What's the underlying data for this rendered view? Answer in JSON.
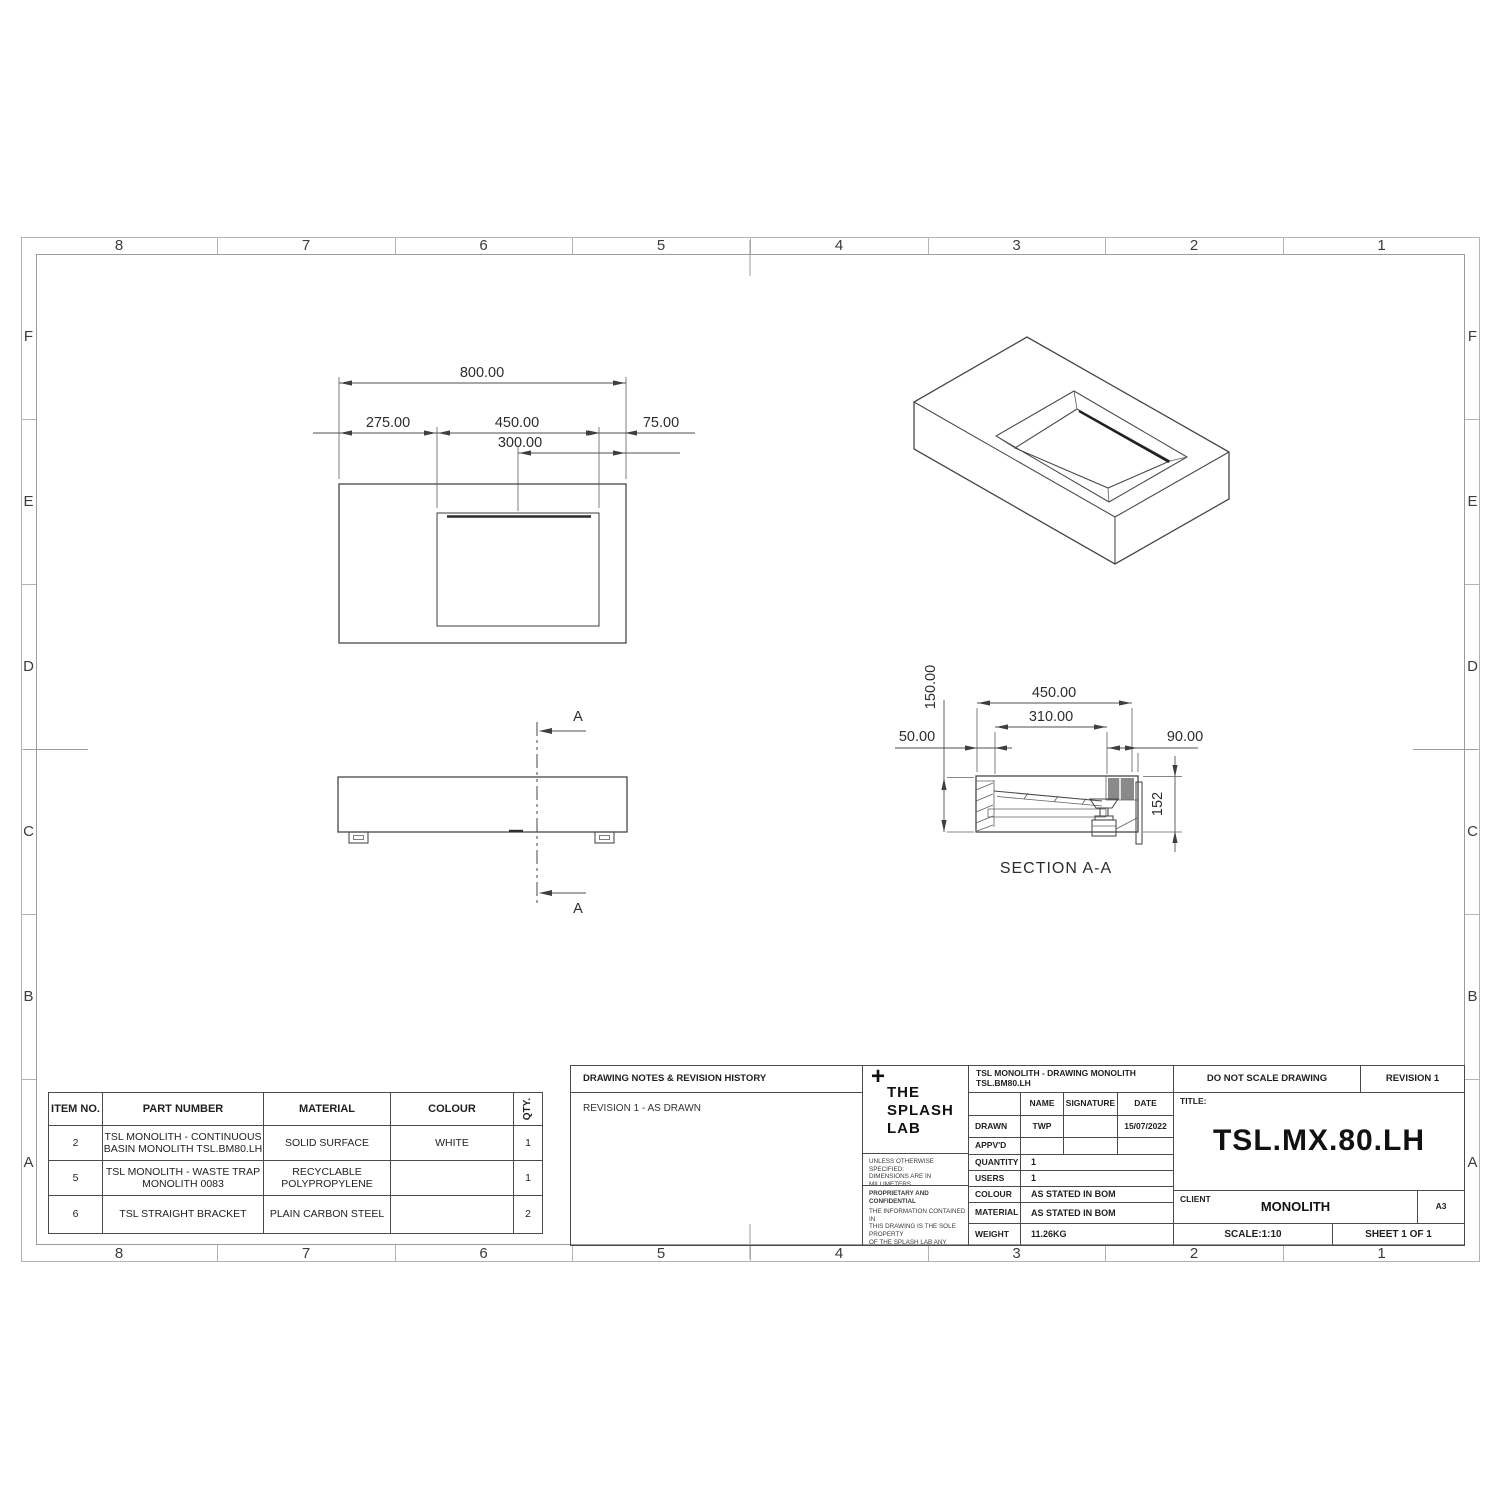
{
  "sheet": {
    "grid_cols": [
      "8",
      "7",
      "6",
      "5",
      "4",
      "3",
      "2",
      "1"
    ],
    "grid_rows": [
      "F",
      "E",
      "D",
      "C",
      "B",
      "A"
    ]
  },
  "plan_view": {
    "dims": {
      "overall": "800.00",
      "left_offset": "275.00",
      "basin_width": "450.00",
      "right_offset": "75.00",
      "drain_offset": "300.00"
    }
  },
  "front_view": {
    "section_label_top": "A",
    "section_label_bottom": "A"
  },
  "section_view": {
    "title": "SECTION A-A",
    "dims": {
      "depth": "150.00",
      "outer_width": "450.00",
      "inner_width": "310.00",
      "left_wall": "50.00",
      "right_wall": "90.00",
      "height": "152"
    }
  },
  "bom": {
    "headers": [
      "ITEM NO.",
      "PART NUMBER",
      "MATERIAL",
      "COLOUR",
      "QTY."
    ],
    "rows": [
      {
        "item": "2",
        "part": "TSL MONOLITH - CONTINUOUS BASIN MONOLITH TSL.BM80.LH",
        "material": "SOLID SURFACE",
        "colour": "WHITE",
        "qty": "1"
      },
      {
        "item": "5",
        "part": "TSL MONOLITH - WASTE TRAP MONOLITH 0083",
        "material": "RECYCLABLE POLYPROPYLENE",
        "colour": "",
        "qty": "1"
      },
      {
        "item": "6",
        "part": "TSL STRAIGHT BRACKET",
        "material": "PLAIN CARBON STEEL",
        "colour": "",
        "qty": "2"
      }
    ]
  },
  "title_block": {
    "notes_header": "DRAWING NOTES & REVISION HISTORY",
    "revision_note": "REVISION 1 - AS DRAWN",
    "logo": {
      "plus": "+",
      "line1": "THE",
      "line2": "SPLASH",
      "line3": "LAB"
    },
    "spec_lines": [
      "UNLESS OTHERWISE SPECIFIED:",
      "DIMENSIONS ARE IN MILLIMETERS",
      "SURFACE FINISH:",
      "TOLERANCES: +/- 3MM"
    ],
    "proprietary_header": "PROPRIETARY AND CONFIDENTIAL",
    "proprietary_lines": [
      "THE INFORMATION CONTAINED IN",
      "THIS DRAWING IS THE SOLE PROPERTY",
      "OF THE SPLASH LAB ANY",
      "REPRODUCTION",
      "IN PART OR AS A WHOLE WITHOUT THE",
      "WRITTEN PERMISSION OF THE SPLASH",
      "LAB IS PROHIBITED"
    ],
    "doc_title": "TSL MONOLITH - DRAWING MONOLITH TSL.BM80.LH",
    "do_not_scale": "DO NOT SCALE DRAWING",
    "revision": "REVISION 1",
    "sig_table": {
      "headers": [
        "NAME",
        "SIGNATURE",
        "DATE"
      ],
      "rows": [
        {
          "label": "DRAWN",
          "name": "TWP",
          "signature": "",
          "date": "15/07/2022"
        },
        {
          "label": "APPV'D",
          "name": "",
          "signature": "",
          "date": ""
        }
      ]
    },
    "fields": [
      {
        "label": "QUANTITY",
        "value": "1"
      },
      {
        "label": "USERS",
        "value": "1"
      },
      {
        "label": "COLOUR",
        "value": "AS STATED IN BOM"
      },
      {
        "label": "MATERIAL",
        "value": "AS STATED IN BOM"
      },
      {
        "label": "WEIGHT",
        "value": "11.26KG"
      }
    ],
    "title_label": "TITLE:",
    "title": "TSL.MX.80.LH",
    "client_label": "CLIENT",
    "client": "MONOLITH",
    "paper_size": "A3",
    "scale": "SCALE:1:10",
    "sheet": "SHEET 1 OF 1"
  }
}
